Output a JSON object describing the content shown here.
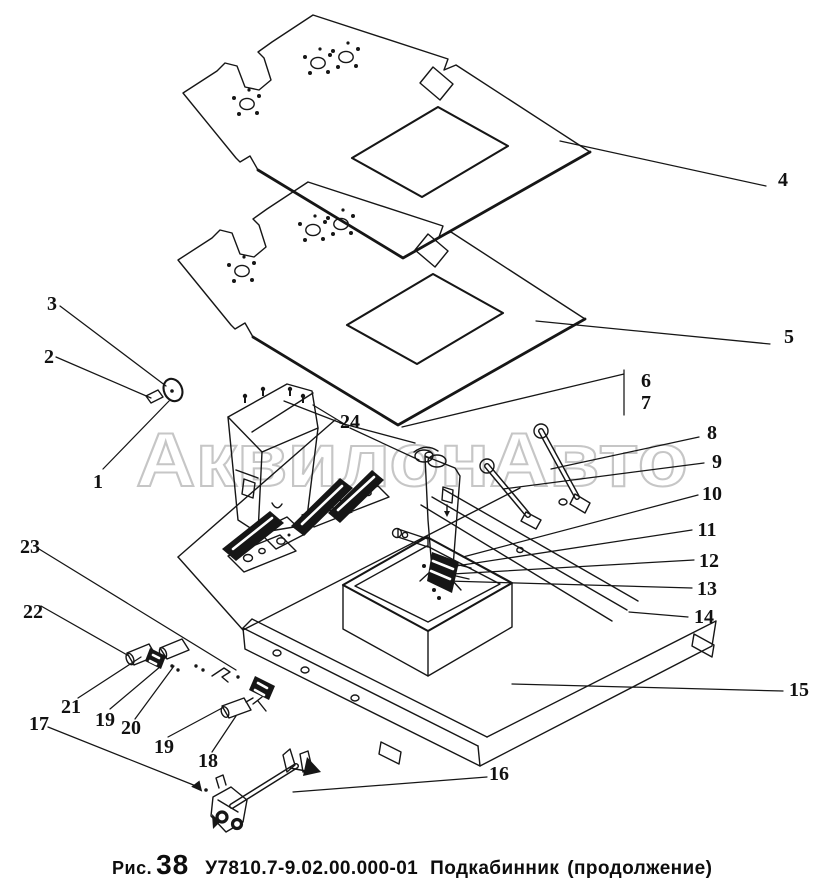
{
  "watermark": "АквилонАвто",
  "caption": {
    "fig_label": "Рис.",
    "fig_number": "38",
    "part_code": "У7810.7-9.02.00.000-01",
    "part_name": "Подкабинник",
    "note": "(продолжение)"
  },
  "callouts": {
    "c1": "1",
    "c2": "2",
    "c3": "3",
    "c4": "4",
    "c5": "5",
    "c6": "6",
    "c7": "7",
    "c8": "8",
    "c9": "9",
    "c10": "10",
    "c11": "11",
    "c12": "12",
    "c13": "13",
    "c14": "14",
    "c15": "15",
    "c16": "16",
    "c17": "17",
    "c18": "18",
    "c19a": "19",
    "c19b": "19",
    "c20": "20",
    "c21": "21",
    "c22": "22",
    "c23": "23",
    "c24": "24"
  },
  "colors": {
    "line": "#161616",
    "watermark_outline": "#c6c6c6",
    "paper": "#ffffff"
  }
}
